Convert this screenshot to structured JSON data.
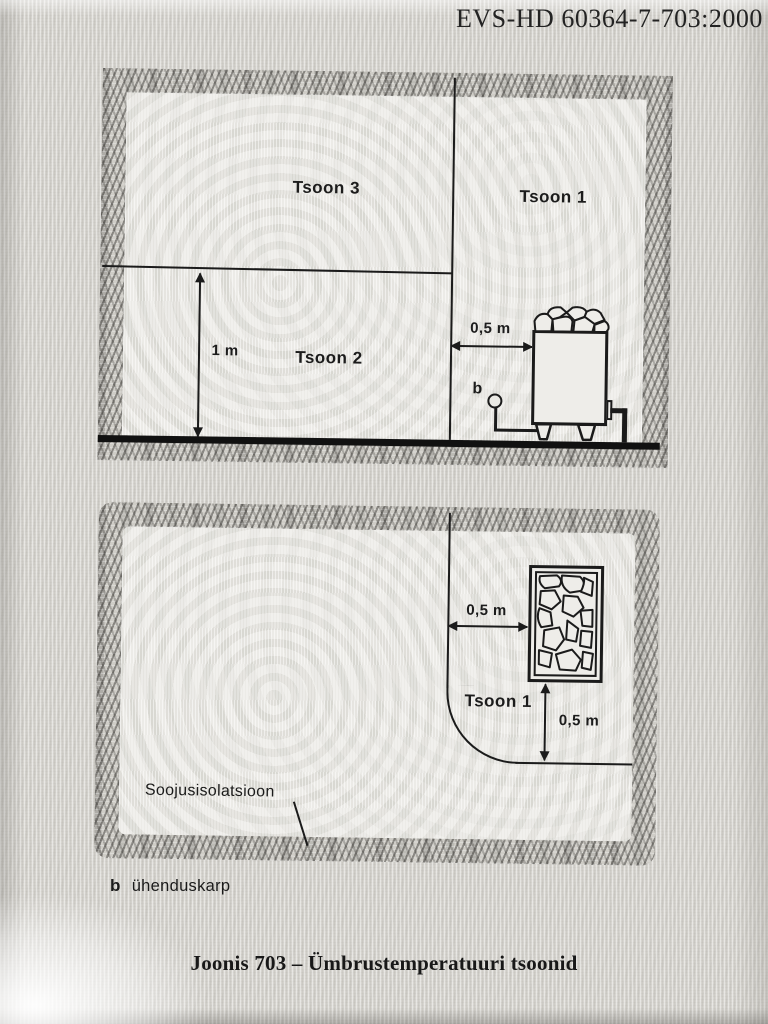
{
  "header": {
    "standard_ref": "EVS-HD 60364-7-703:2000"
  },
  "section_view": {
    "zone3_label": "Tsoon 3",
    "zone1_label": "Tsoon 1",
    "zone2_label": "Tsoon 2",
    "height_dim": "1 m",
    "distance_dim": "0,5 m",
    "junction_marker": "b"
  },
  "plan_view": {
    "zone1_label": "Tsoon 1",
    "distance_dim_left": "0,5 m",
    "distance_dim_bottom": "0,5 m",
    "insulation_label": "Soojusisolatsioon"
  },
  "legend": {
    "marker": "b",
    "description": "ühenduskarp"
  },
  "caption": "Joonis 703 – Ümbrustemperatuuri tsoonid",
  "colors": {
    "ink": "#1b1b1b",
    "paper": "#d8d6d1",
    "hatch": "#cfcdc7"
  }
}
